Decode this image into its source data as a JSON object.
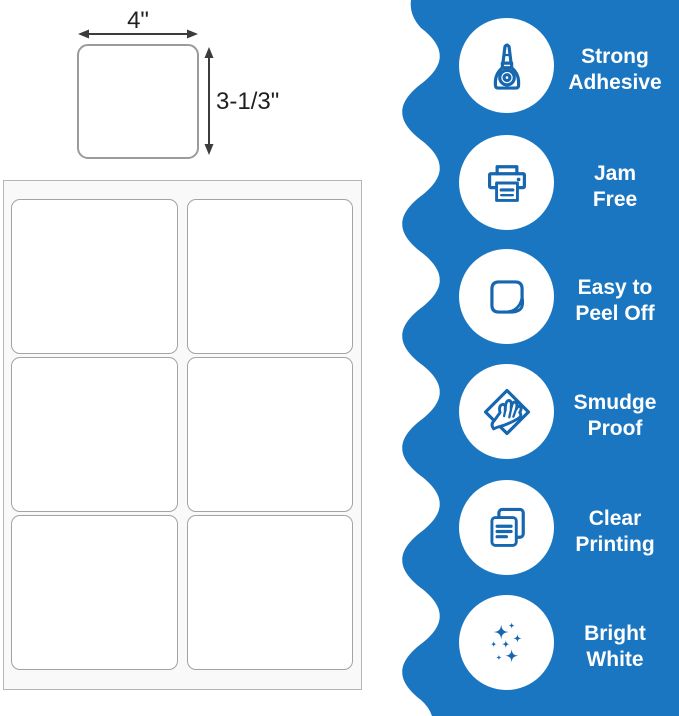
{
  "colors": {
    "accent_blue": "#1b76c1",
    "icon_blue": "#1667b0",
    "text_dark": "#1f1f1f",
    "white": "#ffffff"
  },
  "label_diagram": {
    "width_label": "4\"",
    "height_label": "3-1/3\""
  },
  "sheet": {
    "columns": 2,
    "rows": 3,
    "cell_count": 6
  },
  "features": [
    {
      "icon": "glue-bottle-icon",
      "line1": "Strong",
      "line2": "Adhesive"
    },
    {
      "icon": "printer-icon",
      "line1": "Jam",
      "line2": "Free"
    },
    {
      "icon": "peel-sticker-icon",
      "line1": "Easy to",
      "line2": "Peel Off"
    },
    {
      "icon": "smudge-hand-icon",
      "line1": "Smudge",
      "line2": "Proof"
    },
    {
      "icon": "documents-icon",
      "line1": "Clear",
      "line2": "Printing"
    },
    {
      "icon": "sparkles-icon",
      "line1": "Bright",
      "line2": "White"
    }
  ]
}
